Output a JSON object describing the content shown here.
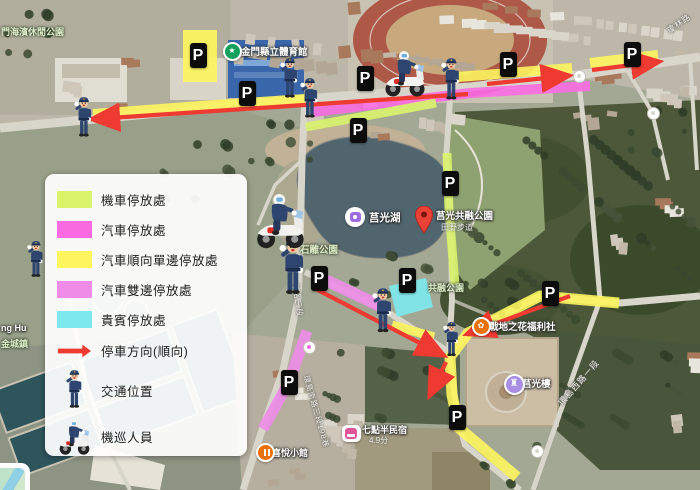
{
  "p_label": "P",
  "colors": {
    "motorcycle": "#d9f36b",
    "car": "#fa6be2",
    "oneway": "#fdf55e",
    "both_sides": "#ee8ce8",
    "vip": "#7de9ee",
    "direction_arrow": "#ee3a30",
    "p_sign_bg": "#0c0c0c",
    "p_sign_text": "#ffffff"
  },
  "legend": {
    "items": [
      {
        "type": "swatch",
        "color_key": "motorcycle",
        "label": "機車停放處"
      },
      {
        "type": "swatch",
        "color_key": "car",
        "label": "汽車停放處"
      },
      {
        "type": "swatch",
        "color_key": "oneway",
        "label": "汽車順向單邊停放處"
      },
      {
        "type": "swatch",
        "color_key": "both_sides",
        "label": "汽車雙邊停放處"
      },
      {
        "type": "swatch",
        "color_key": "vip",
        "label": "貴賓停放處"
      },
      {
        "type": "arrow",
        "label": "停車方向(順向)"
      },
      {
        "type": "officer",
        "label": "交通位置"
      },
      {
        "type": "moto",
        "label": "機巡人員"
      }
    ]
  },
  "map_labels": [
    {
      "text": "門海濱休閒公園",
      "x": 1,
      "y": 25,
      "variant": "area",
      "size": 9
    },
    {
      "text": "金門縣立體育館",
      "x": 241,
      "y": 44,
      "variant": "poi",
      "size": 9.5
    },
    {
      "text": "莒光湖",
      "x": 369,
      "y": 210,
      "variant": "poi",
      "size": 10.5
    },
    {
      "text": "莒光共融公園",
      "x": 436,
      "y": 208,
      "variant": "poi",
      "size": 9.5
    },
    {
      "text": "田野步道",
      "x": 441,
      "y": 222,
      "variant": "sub",
      "size": 8
    },
    {
      "text": "石雕公園",
      "x": 300,
      "y": 242,
      "variant": "area",
      "size": 9.5
    },
    {
      "text": "共融公園",
      "x": 428,
      "y": 281,
      "variant": "area",
      "size": 9
    },
    {
      "text": "戰地之花福利社",
      "x": 489,
      "y": 319,
      "variant": "poi",
      "size": 9.5
    },
    {
      "text": "莒光樓",
      "x": 522,
      "y": 376,
      "variant": "poi",
      "size": 9.5
    },
    {
      "text": "七點半民宿",
      "x": 362,
      "y": 423,
      "variant": "poi",
      "size": 9
    },
    {
      "text": "4.9分",
      "x": 369,
      "y": 435,
      "variant": "sub",
      "size": 8
    },
    {
      "text": "喜悅小館",
      "x": 272,
      "y": 446,
      "variant": "poi",
      "size": 9
    },
    {
      "text": "ng Hu",
      "x": 1,
      "y": 323,
      "variant": "poi",
      "size": 9
    },
    {
      "text": "金城鎮",
      "x": 1,
      "y": 337,
      "variant": "area",
      "size": 9
    },
    {
      "text": "海路三段",
      "x": 295,
      "y": 276,
      "rot": 82,
      "variant": "road",
      "size": 8
    },
    {
      "text": "環島南路三段198巷",
      "x": 306,
      "y": 370,
      "rot": 74,
      "variant": "road",
      "size": 7.5
    },
    {
      "text": "環島西路一段",
      "x": 560,
      "y": 398,
      "rot": -49,
      "variant": "road",
      "size": 8.5
    },
    {
      "text": "瓊林路",
      "x": 668,
      "y": 26,
      "rot": -35,
      "variant": "road",
      "size": 8
    }
  ],
  "pois": [
    {
      "icon": "gym",
      "x": 230,
      "y": 49
    },
    {
      "icon": "photo",
      "x": 355,
      "y": 217
    },
    {
      "icon": "pin",
      "x": 424,
      "y": 233
    },
    {
      "icon": "flower",
      "x": 479,
      "y": 324
    },
    {
      "icon": "tower",
      "x": 512,
      "y": 382
    },
    {
      "icon": "hotel",
      "x": 351,
      "y": 433
    },
    {
      "icon": "food",
      "x": 263,
      "y": 450
    },
    {
      "icon": "junction",
      "x": 578,
      "y": 75
    },
    {
      "icon": "junction",
      "x": 652,
      "y": 112
    },
    {
      "icon": "junction_pink",
      "x": 308,
      "y": 346
    },
    {
      "icon": "junction",
      "x": 536,
      "y": 450
    }
  ],
  "p_signs": [
    {
      "x": 198,
      "y": 55
    },
    {
      "x": 247,
      "y": 93
    },
    {
      "x": 365,
      "y": 78
    },
    {
      "x": 358,
      "y": 130
    },
    {
      "x": 508,
      "y": 64
    },
    {
      "x": 632,
      "y": 54
    },
    {
      "x": 319,
      "y": 278
    },
    {
      "x": 407,
      "y": 280
    },
    {
      "x": 450,
      "y": 183
    },
    {
      "x": 550,
      "y": 293
    },
    {
      "x": 457,
      "y": 417
    },
    {
      "x": 289,
      "y": 382
    }
  ],
  "officers": [
    {
      "x": 84,
      "y": 96,
      "h": 44
    },
    {
      "x": 290,
      "y": 57,
      "h": 44
    },
    {
      "x": 310,
      "y": 77,
      "h": 44
    },
    {
      "x": 451,
      "y": 57,
      "h": 46
    },
    {
      "x": 293,
      "y": 237,
      "h": 62
    },
    {
      "x": 383,
      "y": 287,
      "h": 49
    },
    {
      "x": 452,
      "y": 321,
      "h": 38
    },
    {
      "x": 36,
      "y": 240,
      "h": 40
    }
  ],
  "moto_patrols": [
    {
      "x": 405,
      "y": 46,
      "h": 52
    },
    {
      "x": 280,
      "y": 188,
      "h": 62
    }
  ],
  "overlays": {
    "yellow_rect": {
      "x": 183,
      "y": 30,
      "w": 34,
      "h": 52
    },
    "vip_zone": [
      [
        389,
        286
      ],
      [
        426,
        278
      ],
      [
        433,
        307
      ],
      [
        397,
        317
      ]
    ],
    "strips": [
      {
        "color": "oneway",
        "w": 10,
        "pts": [
          [
            93,
            114
          ],
          [
            200,
            106
          ],
          [
            305,
            99
          ]
        ]
      },
      {
        "color": "oneway",
        "w": 10,
        "pts": [
          [
            458,
            77
          ],
          [
            572,
            68
          ]
        ]
      },
      {
        "color": "oneway",
        "w": 10,
        "pts": [
          [
            590,
            63
          ],
          [
            658,
            55
          ]
        ]
      },
      {
        "color": "car",
        "w": 10,
        "pts": [
          [
            313,
            112
          ],
          [
            470,
            93
          ],
          [
            590,
            86
          ]
        ]
      },
      {
        "color": "motorcycle",
        "w": 9,
        "pts": [
          [
            306,
            127
          ],
          [
            436,
            103
          ]
        ]
      },
      {
        "color": "motorcycle",
        "w": 9,
        "pts": [
          [
            447,
            153
          ],
          [
            449,
            210
          ],
          [
            455,
            285
          ]
        ]
      },
      {
        "color": "both_sides",
        "w": 12,
        "pts": [
          [
            317,
            276
          ],
          [
            380,
            306
          ]
        ]
      },
      {
        "color": "both_sides",
        "w": 11,
        "pts": [
          [
            307,
            331
          ],
          [
            289,
            382
          ],
          [
            263,
            429
          ]
        ]
      },
      {
        "color": "oneway",
        "w": 9,
        "pts": [
          [
            392,
            325
          ],
          [
            434,
            337
          ]
        ]
      },
      {
        "color": "oneway",
        "w": 11,
        "pts": [
          [
            619,
            303
          ],
          [
            540,
            296
          ],
          [
            468,
            333
          ],
          [
            450,
            357
          ],
          [
            452,
            395
          ],
          [
            459,
            428
          ],
          [
            517,
            477
          ]
        ]
      }
    ],
    "arrows": [
      {
        "from": [
          468,
          94
        ],
        "to": [
          95,
          119
        ]
      },
      {
        "from": [
          487,
          84
        ],
        "to": [
          566,
          76
        ]
      },
      {
        "from": [
          592,
          70
        ],
        "to": [
          656,
          62
        ]
      },
      {
        "from": [
          312,
          287
        ],
        "to": [
          441,
          354
        ]
      },
      {
        "from": [
          570,
          296
        ],
        "to": [
          470,
          333
        ]
      },
      {
        "from": [
          446,
          362
        ],
        "to": [
          431,
          393
        ]
      }
    ]
  }
}
